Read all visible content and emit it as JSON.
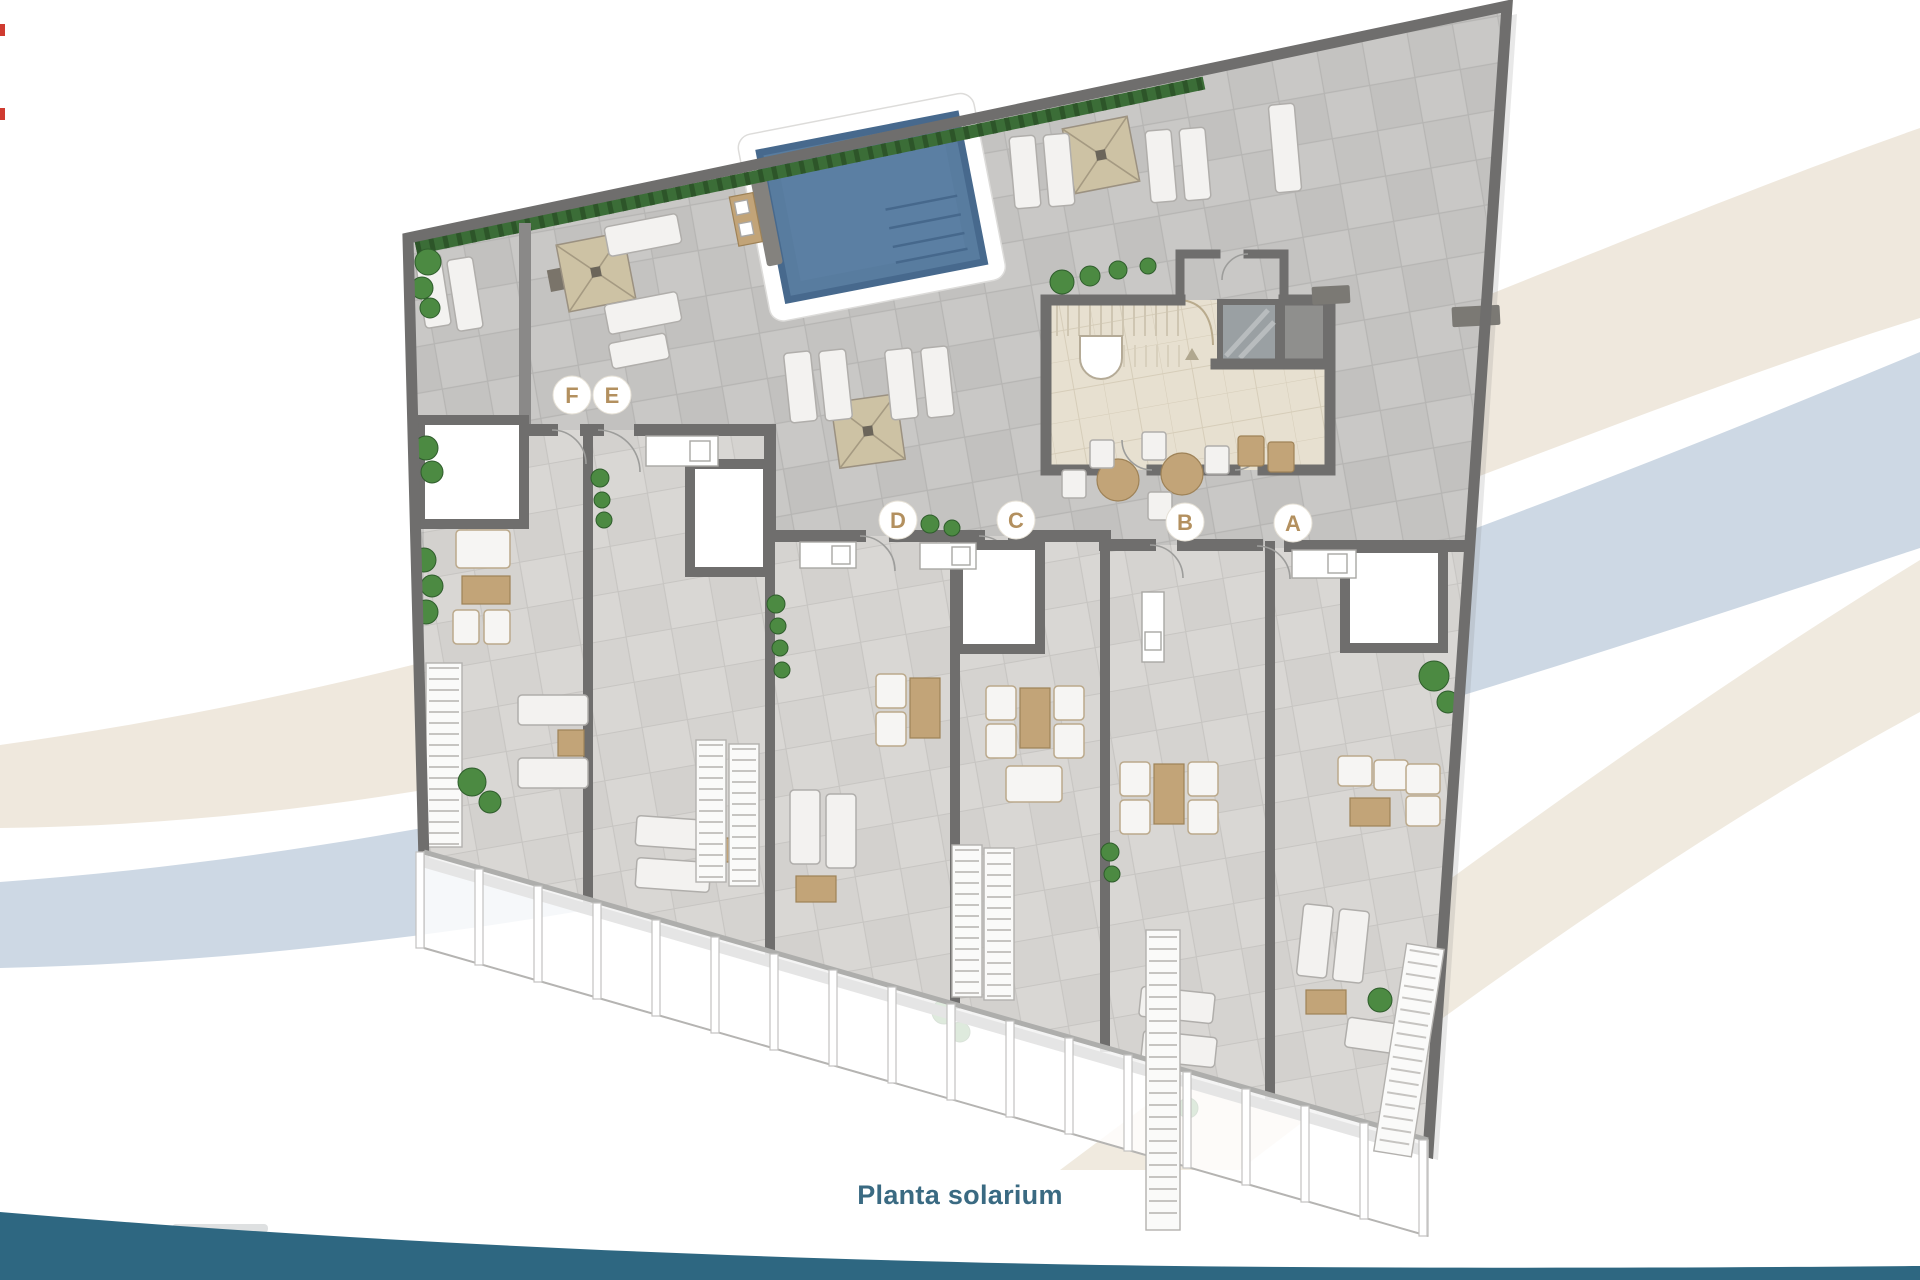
{
  "page": {
    "background_color": "#ffffff"
  },
  "background_graphics": {
    "swoosh_cream_color": "#efe8dd",
    "swoosh_blue_color": "#cdd8e4",
    "swoosh_pale_color": "#f0eadf",
    "bottom_wave_color": "#2e6781",
    "edge_mark_color": "#cf3b30"
  },
  "caption": {
    "text": "Planta solarium",
    "color": "#3a6a82"
  },
  "floor_plan": {
    "name": "Planta solarium",
    "unit_labels": [
      {
        "id": "F"
      },
      {
        "id": "E"
      },
      {
        "id": "D"
      },
      {
        "id": "C"
      },
      {
        "id": "B"
      },
      {
        "id": "A"
      }
    ],
    "label_letter_color": "#b3905f",
    "label_circle_color": "#ffffff",
    "materials": {
      "deck_tile": "#c9c8c6",
      "terrace_tile": "#d9d7d4",
      "wall": "#6f6e6d",
      "core_floor": "#e7e0d0",
      "pool_water": "#587c9f",
      "pool_deck": "#ffffff",
      "pergola": "#cdc2a4",
      "lounger": "#f3f2f0",
      "wood_furniture": "#c2a478",
      "hedge": "#3b6d37",
      "bush": "#4c8a42",
      "glass_balustrade": "#ffffff"
    },
    "features": [
      "swimming-pool",
      "pergolas",
      "sun-loungers",
      "outdoor-kitchens",
      "stair-core",
      "elevator",
      "private-terraces",
      "planters",
      "glass-balustrade",
      "staircases",
      "roof-skylights"
    ]
  }
}
